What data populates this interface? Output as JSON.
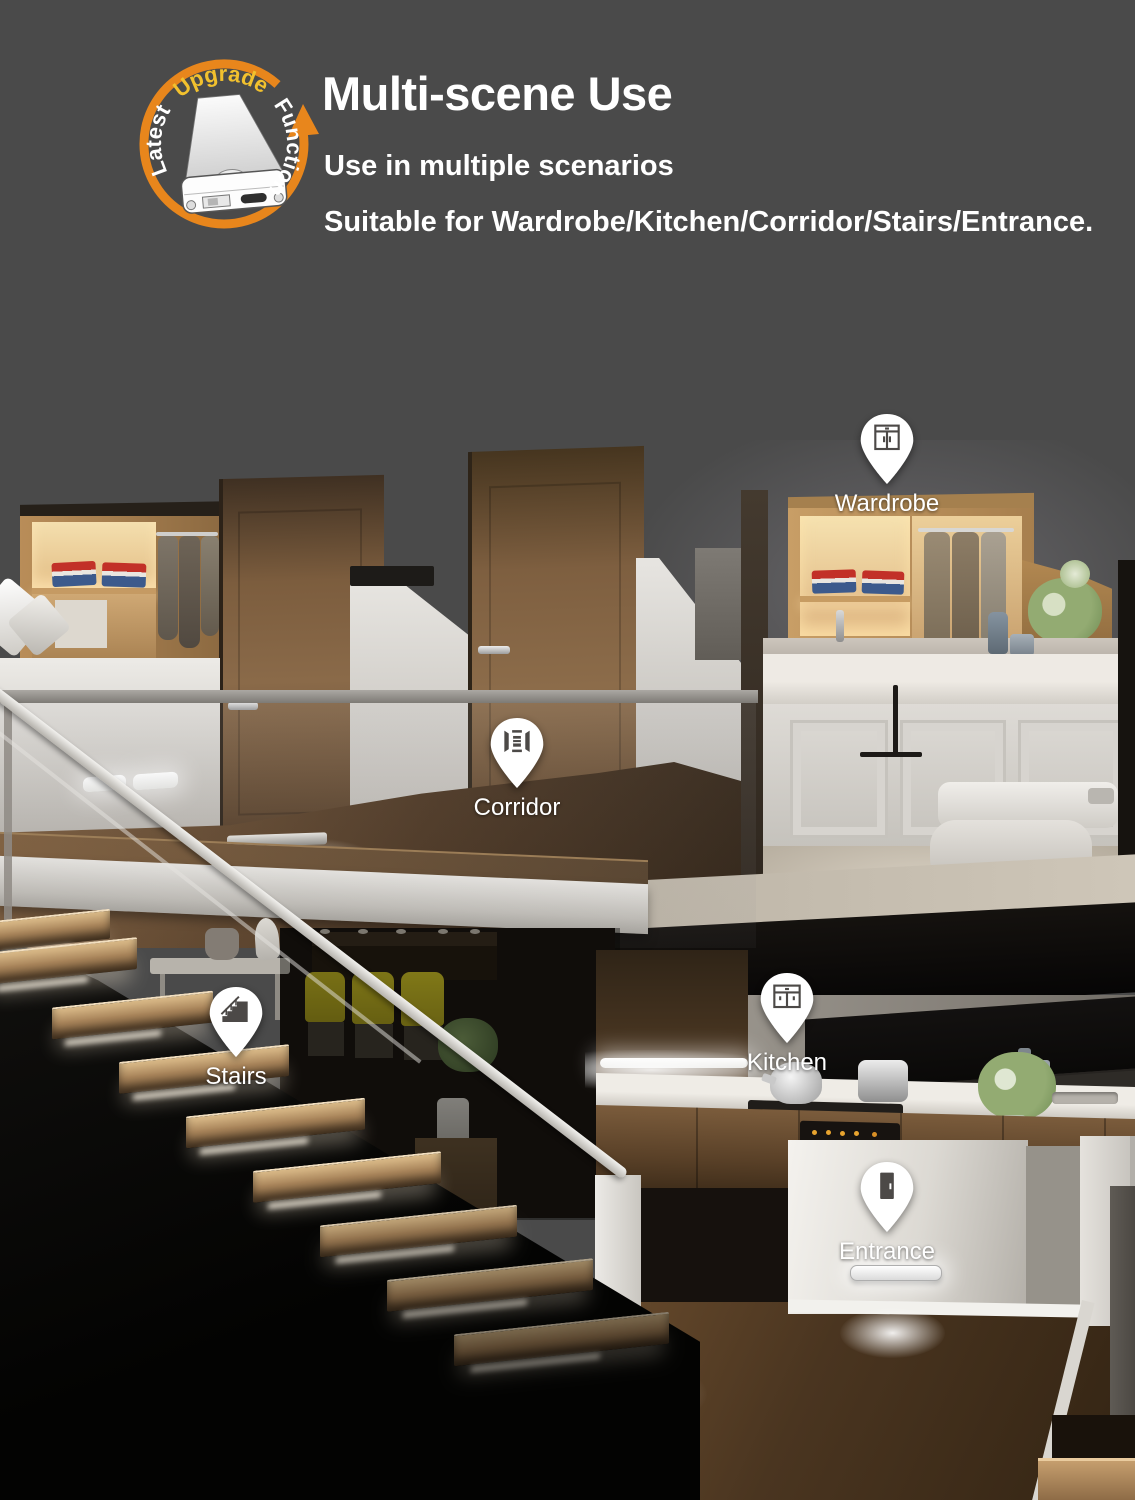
{
  "page": {
    "background": "#4a4a4a"
  },
  "badge": {
    "word1": "Latest",
    "word2": "Upgrade",
    "word3": "Function",
    "arc_color": "#E8861C",
    "word2_color": "#F2C12E",
    "word_color": "#FFFFFF",
    "product_icon": "led-motion-sensor-light-icon"
  },
  "header": {
    "title": "Multi-scene Use",
    "subtitle": "Use in multiple scenarios",
    "description": "Suitable for Wardrobe/Kitchen/Corridor/Stairs/Entrance."
  },
  "pins": [
    {
      "label": "Wardrobe",
      "icon": "wardrobe-icon"
    },
    {
      "label": "Corridor",
      "icon": "corridor-icon"
    },
    {
      "label": "Stairs",
      "icon": "stairs-icon"
    },
    {
      "label": "Kitchen",
      "icon": "kitchen-icon"
    },
    {
      "label": "Entrance",
      "icon": "entrance-icon"
    }
  ],
  "colors": {
    "pin_fill": "#FFFFFF",
    "pin_glyph": "#4C4947",
    "text": "#FFFFFF",
    "warm_light": "#F6E3B8",
    "cool_light": "#FFFFFF"
  }
}
